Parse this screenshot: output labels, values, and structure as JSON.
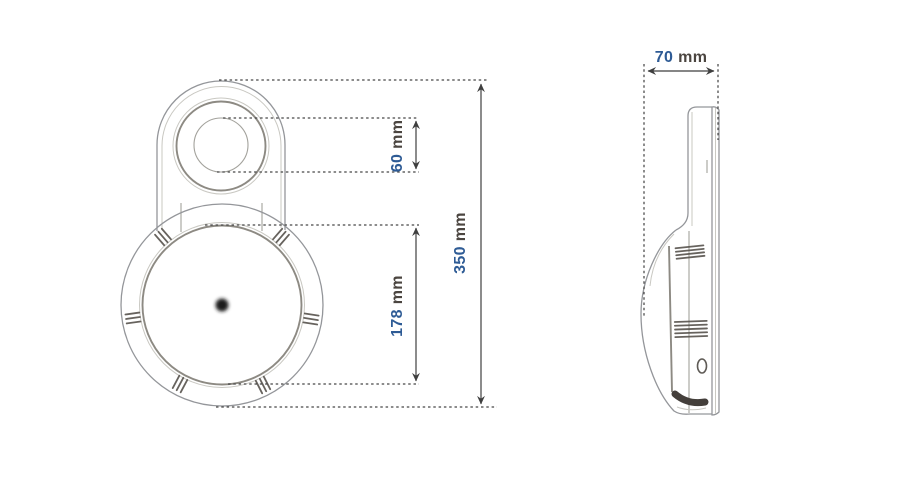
{
  "dimensions": {
    "hole_diameter": {
      "value": "60",
      "unit": "mm"
    },
    "body_diameter": {
      "value": "178",
      "unit": "mm"
    },
    "overall_height": {
      "value": "350",
      "unit": "mm"
    },
    "depth": {
      "value": "70",
      "unit": "mm"
    }
  },
  "colors": {
    "background": "#ffffff",
    "value_text": "#2e5b95",
    "unit_text": "#4b4540",
    "dimension_line": "#3f3f3f",
    "drawing_line": "#94969a",
    "drawing_line_dark": "#8d8a83",
    "ridge_mark": "#57524c"
  }
}
